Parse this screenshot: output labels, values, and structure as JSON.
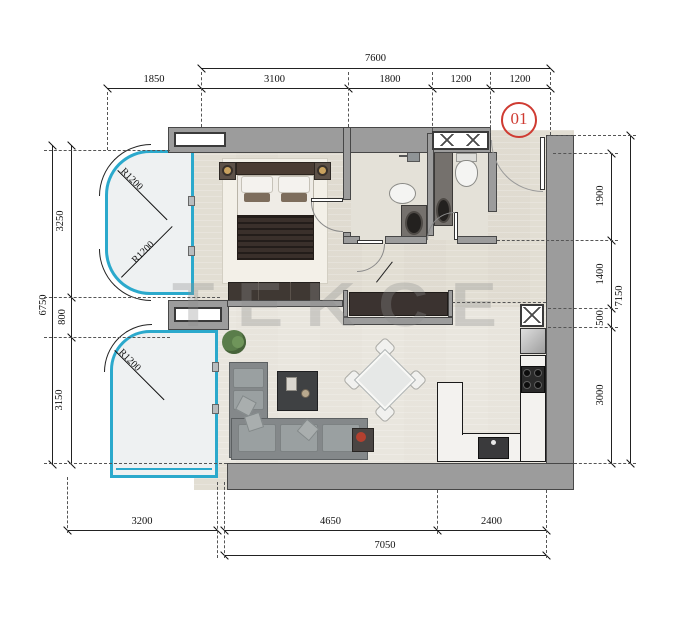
{
  "unit_badge": "01",
  "watermark_text": "TEKCE",
  "dimensions": {
    "top": {
      "overall": "7600",
      "segments": [
        "1850",
        "3100",
        "1800",
        "1200",
        "1200"
      ]
    },
    "bottom": {
      "overall": "7050",
      "segments": [
        "3200",
        "4650",
        "2400"
      ]
    },
    "left": {
      "overall": "6750",
      "segments": [
        "3250",
        "800",
        "3150"
      ]
    },
    "right": {
      "overall": "7150",
      "segments": [
        "1900",
        "1400",
        "500",
        "3000"
      ]
    },
    "radii": {
      "r1": "R1200",
      "r2": "R1200",
      "r3": "R1200"
    }
  },
  "colors": {
    "wall": "#9c9c9c",
    "wall_outline": "#474747",
    "floor": "#e8e4da",
    "balcony_fill": "#eef1f2",
    "balcony_glass": "#2ba9cc",
    "dim_line": "#222222",
    "unit_badge_red": "#cf3b32",
    "furniture_dark": "#3f3833",
    "sofa_gray": "#84888a",
    "counter_marble": "#f3f2ef"
  }
}
